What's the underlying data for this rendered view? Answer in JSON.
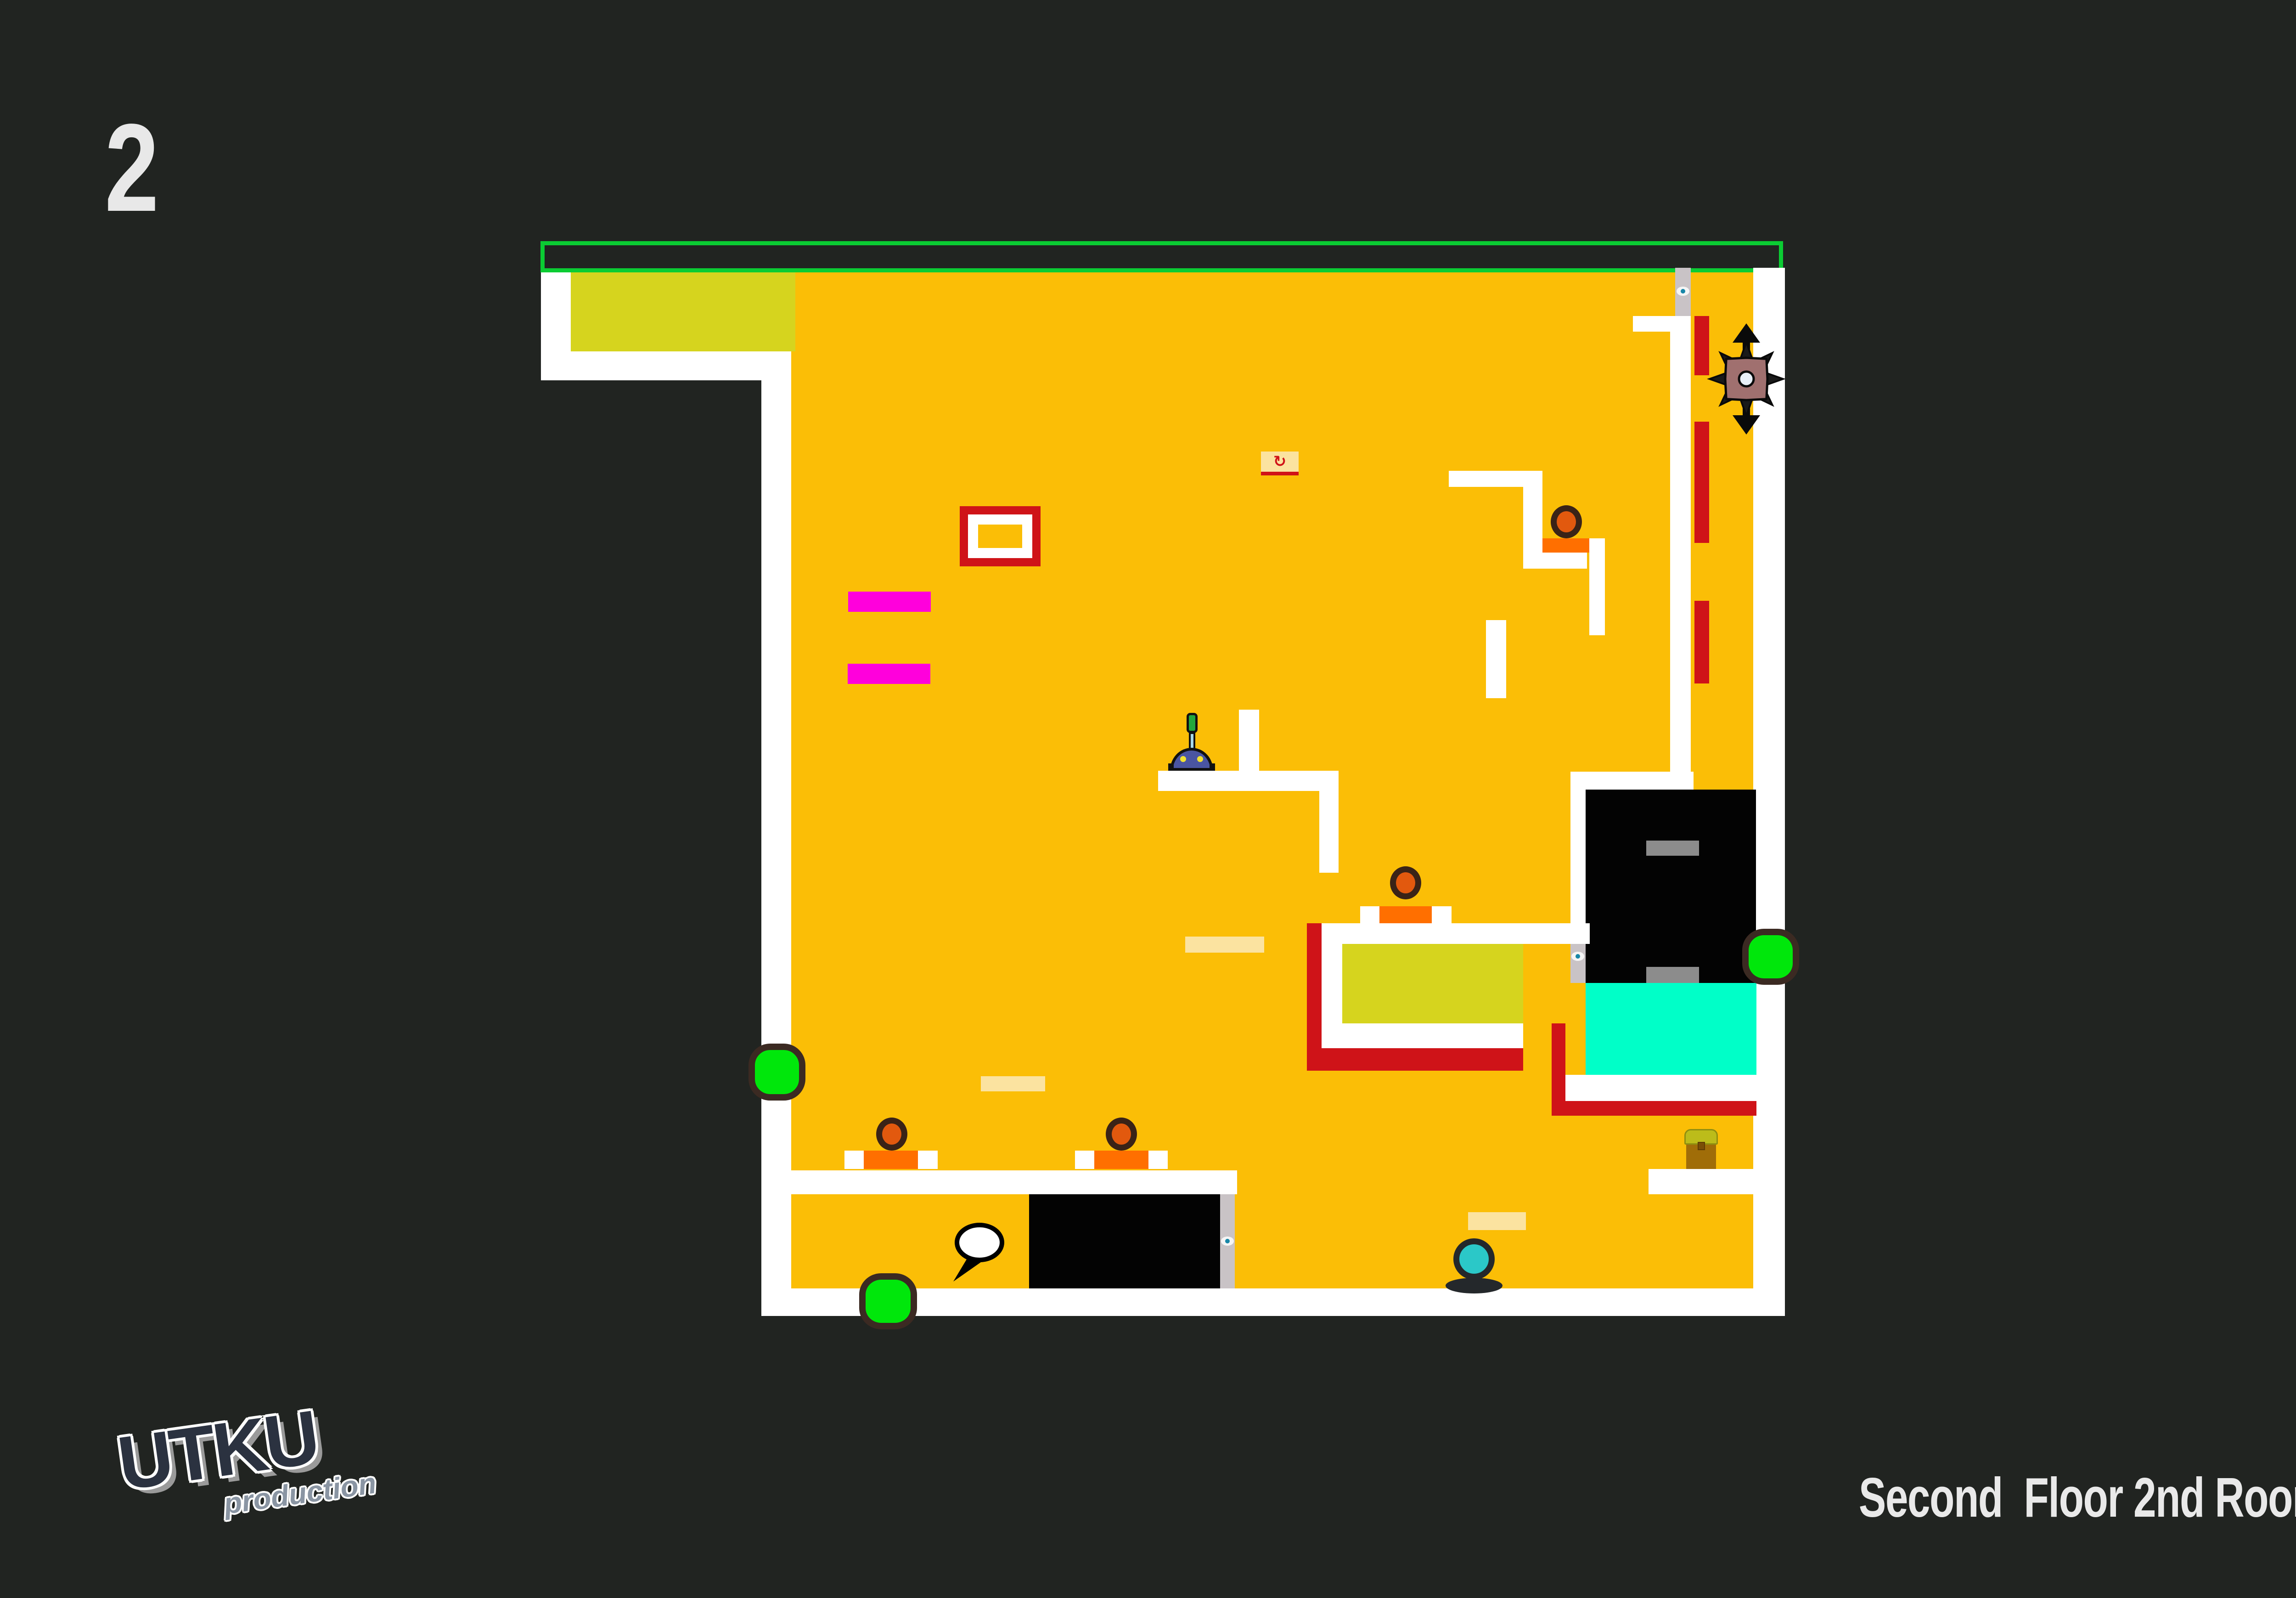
{
  "page": {
    "title_number": "2",
    "footer_text": "Second  Floor 2nd Room",
    "logo_main": "UTKU",
    "logo_sub": "production"
  },
  "colors": {
    "background": "#212421",
    "field_orange": "#FBBE06",
    "wall_white": "#FFFFFF",
    "frame_green": "#0BCC33",
    "accent_yellowgreen": "#D6D41E",
    "hazard_red": "#CF1318",
    "step_orange": "#FF6F00",
    "magenta": "#FF00DC",
    "cyan_block": "#00FFC8",
    "enemy_fill": "#E2590E",
    "enemy_ring": "#3A2317",
    "orb_green": "#00E70B",
    "orb_ring": "#3B2A22",
    "spiky_body": "#A0706F",
    "spiky_dark": "#0A0A0A",
    "robot_body": "#4A55A2",
    "robot_antenna_tip": "#22A83C",
    "player_fill": "#2BC8C8",
    "track_gray": "#C9C3C6",
    "inner_gray": "#8C8C8C",
    "pale_bar": "#FBE3A0",
    "chest_lid": "#BCBC1A",
    "chest_body": "#A06D08",
    "checkpoint_red": "#D01318",
    "text_light": "#E9E9E9",
    "logo_dark": "#2B3240",
    "logo_gray": "#8A95A3"
  },
  "level": {
    "rects": [
      {
        "name": "orange-field",
        "style": "left:1723px;top:593px;width:2095px;height:2212px;background:#FBBE06"
      },
      {
        "name": "goal-frame-green",
        "style": "left:1177px;top:525px;width:2706px;height:68px;border:9px solid #0BCC33"
      },
      {
        "name": "topleft-white-sliver",
        "style": "left:1178px;top:593px;width:65px;height:172px;background:#FFFFFF"
      },
      {
        "name": "topleft-yellow-block",
        "style": "left:1243px;top:593px;width:489px;height:172px;background:#D6D41E"
      },
      {
        "name": "topleft-white-band",
        "style": "left:1178px;top:765px;width:545px;height:63px;background:#FFFFFF"
      },
      {
        "name": "left-wall",
        "style": "left:1658px;top:828px;width:65px;height:2037px;background:#FFFFFF"
      },
      {
        "name": "right-wall",
        "style": "left:3818px;top:583px;width:69px;height:2282px;background:#FFFFFF"
      },
      {
        "name": "bottom-floor",
        "style": "left:1658px;top:2805px;width:2229px;height:60px;background:#FFFFFF"
      },
      {
        "name": "robot-platform",
        "style": "left:2522px;top:1678px;width:393px;height:44px;background:#FFFFFF"
      },
      {
        "name": "robot-platform-upper-bar",
        "style": "left:2698px;top:1545px;width:44px;height:133px;background:#FFFFFF"
      },
      {
        "name": "robot-platform-lower-bar",
        "style": "left:2873px;top:1722px;width:42px;height:178px;background:#FFFFFF"
      },
      {
        "name": "step-top-platform",
        "style": "left:3155px;top:1025px;width:204px;height:35px;background:#FFFFFF"
      },
      {
        "name": "step-left-vertical",
        "style": "left:3317px;top:1060px;width:42px;height:178px;background:#FFFFFF"
      },
      {
        "name": "step-foot",
        "style": "left:3359px;top:1203px;width:97px;height:35px;background:#FFFFFF"
      },
      {
        "name": "step-orange-block",
        "style": "left:3359px;top:1172px;width:104px;height:31px;background:#FF6F00"
      },
      {
        "name": "step-right-vertical",
        "style": "left:3461px;top:1172px;width:34px;height:211px;background:#FFFFFF"
      },
      {
        "name": "mid-small-vertical",
        "style": "left:3236px;top:1350px;width:44px;height:170px;background:#FFFFFF"
      },
      {
        "name": "topright-band",
        "style": "left:3556px;top:688px;width:126px;height:34px;background:#FFFFFF"
      },
      {
        "name": "topright-track",
        "style": "left:3637px;top:722px;width:45px;height:958px;background:#FFFFFF"
      },
      {
        "name": "topright-gray-strip",
        "style": "left:3648px;top:583px;width:34px;height:105px;background:#C9C3C6"
      },
      {
        "name": "red-dash-1",
        "style": "left:3690px;top:688px;width:32px;height:129px;background:#CF1318"
      },
      {
        "name": "red-dash-2",
        "style": "left:3690px;top:918px;width:32px;height:264px;background:#CF1318"
      },
      {
        "name": "red-dash-3",
        "style": "left:3690px;top:1308px;width:32px;height:180px;background:#CF1318"
      },
      {
        "name": "bigbox-top-band",
        "style": "left:3420px;top:1680px;width:268px;height:39px;background:#FFFFFF"
      },
      {
        "name": "bigbox-left-sliver",
        "style": "left:3420px;top:1719px;width:33px;height:301px;background:#FFFFFF"
      },
      {
        "name": "bigbox-left-gray",
        "style": "left:3420px;top:2020px;width:33px;height:120px;background:#C9C3C6"
      },
      {
        "name": "big-black-box",
        "style": "left:3453px;top:1719px;width:371px;height:421px;background:#030303"
      },
      {
        "name": "bigbox-gray-bar-top",
        "style": "left:3585px;top:1830px;width:115px;height:33px;background:#8C8C8C"
      },
      {
        "name": "bigbox-gray-bar-bottom",
        "style": "left:3585px;top:2105px;width:115px;height:35px;background:#8C8C8C"
      },
      {
        "name": "cyan-block",
        "style": "left:3453px;top:2140px;width:372px;height:200px;background:#00FFC8"
      },
      {
        "name": "cyan-under-band",
        "style": "left:3409px;top:2340px;width:416px;height:57px;background:#FFFFFF"
      },
      {
        "name": "red-L-vertical",
        "style": "left:3379px;top:2228px;width:30px;height:201px;background:#CF1318"
      },
      {
        "name": "red-L-horizontal",
        "style": "left:3409px;top:2397px;width:416px;height:32px;background:#CF1318"
      },
      {
        "name": "chest-platform",
        "style": "left:3590px;top:2545px;width:235px;height:55px;background:#FFFFFF"
      },
      {
        "name": "pool-red-left",
        "style": "left:2846px;top:2010px;width:32px;height:321px;background:#CF1318"
      },
      {
        "name": "pool-top-band",
        "style": "left:2878px;top:2010px;width:584px;height:45px;background:#FFFFFF"
      },
      {
        "name": "pool-left-white",
        "style": "left:2878px;top:2055px;width:45px;height:173px;background:#FFFFFF"
      },
      {
        "name": "pool-interior",
        "style": "left:2923px;top:2055px;width:394px;height:173px;background:#D6D41E"
      },
      {
        "name": "pool-bottom-white",
        "style": "left:2878px;top:2228px;width:439px;height:54px;background:#FFFFFF"
      },
      {
        "name": "pool-red-bottom",
        "style": "left:2878px;top:2282px;width:439px;height:49px;background:#CF1318"
      },
      {
        "name": "enemy4-plat-white-left",
        "style": "left:2962px;top:1973px;width:42px;height:37px;background:#FFFFFF"
      },
      {
        "name": "enemy4-plat-orange",
        "style": "left:3004px;top:1973px;width:114px;height:37px;background:#FF6F00"
      },
      {
        "name": "enemy4-plat-white-right",
        "style": "left:3118px;top:1973px;width:43px;height:37px;background:#FFFFFF"
      },
      {
        "name": "bottomroom-ceiling",
        "style": "left:1700px;top:2548px;width:994px;height:52px;background:#FFFFFF"
      },
      {
        "name": "enemy1-plat-white-left",
        "style": "left:1839px;top:2505px;width:42px;height:40px;background:#FFFFFF"
      },
      {
        "name": "enemy1-plat-orange",
        "style": "left:1881px;top:2505px;width:118px;height:40px;background:#FF6F00"
      },
      {
        "name": "enemy1-plat-white-right",
        "style": "left:1999px;top:2505px;width:43px;height:40px;background:#FFFFFF"
      },
      {
        "name": "enemy2-plat-white-left",
        "style": "left:2341px;top:2505px;width:42px;height:40px;background:#FFFFFF"
      },
      {
        "name": "enemy2-plat-orange",
        "style": "left:2383px;top:2505px;width:118px;height:40px;background:#FF6F00"
      },
      {
        "name": "enemy2-plat-white-right",
        "style": "left:2501px;top:2505px;width:42px;height:40px;background:#FFFFFF"
      },
      {
        "name": "bottom-black-box",
        "style": "left:2241px;top:2600px;width:416px;height:205px;background:#030303"
      },
      {
        "name": "bottom-box-gray-strip",
        "style": "left:2657px;top:2600px;width:32px;height:205px;background:#C9C3C6"
      },
      {
        "name": "pale-bar-1",
        "style": "left:2581px;top:2039px;width:172px;height:35px;background:#FBE3A0"
      },
      {
        "name": "pale-bar-2",
        "style": "left:2136px;top:2343px;width:140px;height:33px;background:#FBE3A0"
      },
      {
        "name": "pale-bar-3",
        "style": "left:3197px;top:2639px;width:126px;height:39px;background:#FBE3A0"
      },
      {
        "name": "magenta-bar-1",
        "style": "left:1847px;top:1288px;width:180px;height:44px;background:#FF00DC"
      },
      {
        "name": "magenta-bar-2",
        "style": "left:1846px;top:1445px;width:180px;height:44px;background:#FF00DC"
      },
      {
        "name": "item-frame-red",
        "style": "left:2090px;top:1102px;width:176px;height:131px;background:#CF1318"
      },
      {
        "name": "item-frame-white",
        "style": "left:2108px;top:1120px;width:140px;height:95px;background:#FFFFFF"
      },
      {
        "name": "item-frame-core",
        "style": "left:2130px;top:1142px;width:96px;height:51px;background:#FBBE06"
      }
    ],
    "objects": {
      "checkpoint": {
        "style": "left:2746px;top:983px",
        "glyph": "↻"
      },
      "enemy1": {
        "style": "left:1908px;top:2433px"
      },
      "enemy2": {
        "style": "left:2408px;top:2433px"
      },
      "enemy3": {
        "style": "left:3377px;top:1100px"
      },
      "enemy4": {
        "style": "left:3027px;top:1886px"
      },
      "orb1": {
        "style": "left:1630px;top:2272px;width:124px;height:124px"
      },
      "orb2": {
        "style": "left:1871px;top:2772px;width:126px;height:122px"
      },
      "orb3": {
        "style": "left:3794px;top:2022px;width:124px;height:122px"
      },
      "spiky": {
        "style": "left:3713px;top:700px;width:180px;height:250px"
      },
      "robot": {
        "style": "left:2548px;top:1552px"
      },
      "player": {
        "style": "left:3148px;top:2696px"
      },
      "bubble": {
        "style": "left:2068px;top:2660px;width:130px;height:135px"
      },
      "chest": {
        "style": "left:3668px;top:2458px"
      },
      "button1": {
        "style": "left:3651px;top:624px"
      },
      "button2": {
        "style": "left:3422px;top:2072px"
      },
      "button3": {
        "style": "left:2659px;top:2692px"
      }
    }
  }
}
